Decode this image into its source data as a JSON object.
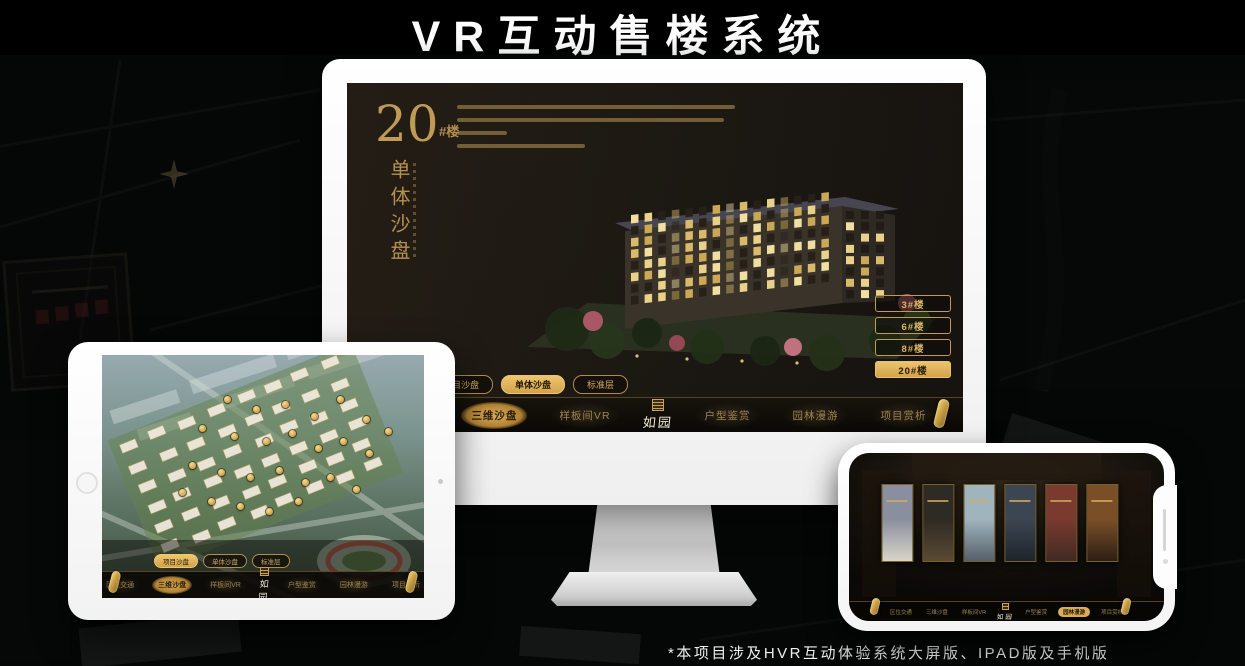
{
  "page": {
    "title": "VR互动售楼系统",
    "footnote": "*本项目涉及HVR互动体验系统大屏版、IPAD版及手机版"
  },
  "colors": {
    "gold": "#d8ac5f",
    "gold_deep": "#b8863c",
    "nav_text": "#9a8352",
    "active_text": "#241a08",
    "screen_bg": "#1b1712"
  },
  "logo": {
    "text": "如园"
  },
  "nav": {
    "items": [
      {
        "label": "区位交通"
      },
      {
        "label": "三维沙盘"
      },
      {
        "label": "样板间VR"
      },
      {
        "label": "户型鉴赏"
      },
      {
        "label": "园林漫游"
      },
      {
        "label": "项目赏析"
      }
    ]
  },
  "desktop": {
    "hero": {
      "number": "20",
      "suffix": "#楼",
      "title_vertical": "单体沙盘",
      "paragraph_line_widths": [
        100,
        96,
        18,
        46
      ]
    },
    "floor_buttons": [
      {
        "label": "3#楼",
        "active": false
      },
      {
        "label": "6#楼",
        "active": false
      },
      {
        "label": "8#楼",
        "active": false
      },
      {
        "label": "20#楼",
        "active": true
      }
    ],
    "sub_tabs": [
      {
        "label": "项目沙盘",
        "active": false
      },
      {
        "label": "单体沙盘",
        "active": true
      },
      {
        "label": "标准层",
        "active": false
      }
    ],
    "nav_active": "三维沙盘"
  },
  "tablet": {
    "sub_tabs": [
      {
        "label": "项目沙盘",
        "active": true
      },
      {
        "label": "单体沙盘",
        "active": false
      },
      {
        "label": "标准层",
        "active": false
      }
    ],
    "nav_active": "三维沙盘",
    "markers": [
      [
        38,
        17
      ],
      [
        47,
        21
      ],
      [
        56,
        19
      ],
      [
        65,
        24
      ],
      [
        73,
        17
      ],
      [
        81,
        25
      ],
      [
        88,
        30
      ],
      [
        30,
        29
      ],
      [
        40,
        32
      ],
      [
        50,
        34
      ],
      [
        58,
        31
      ],
      [
        66,
        37
      ],
      [
        74,
        34
      ],
      [
        82,
        39
      ],
      [
        27,
        44
      ],
      [
        36,
        47
      ],
      [
        45,
        49
      ],
      [
        54,
        46
      ],
      [
        62,
        51
      ],
      [
        70,
        49
      ],
      [
        78,
        54
      ],
      [
        33,
        59
      ],
      [
        42,
        61
      ],
      [
        51,
        63
      ],
      [
        60,
        59
      ],
      [
        24,
        55
      ]
    ]
  },
  "phone": {
    "nav_active": "园林漫游",
    "panels": [
      {
        "top": "#8a8fa0",
        "bottom": "#d8d5c8"
      },
      {
        "top": "#2e2a24",
        "bottom": "#5a4a32"
      },
      {
        "top": "#9fb4bc",
        "bottom": "#55606a"
      },
      {
        "top": "#3c4652",
        "bottom": "#1e242c"
      },
      {
        "top": "#7a3a30",
        "bottom": "#402a22"
      },
      {
        "top": "#7a4f28",
        "bottom": "#2e1f14"
      }
    ]
  }
}
